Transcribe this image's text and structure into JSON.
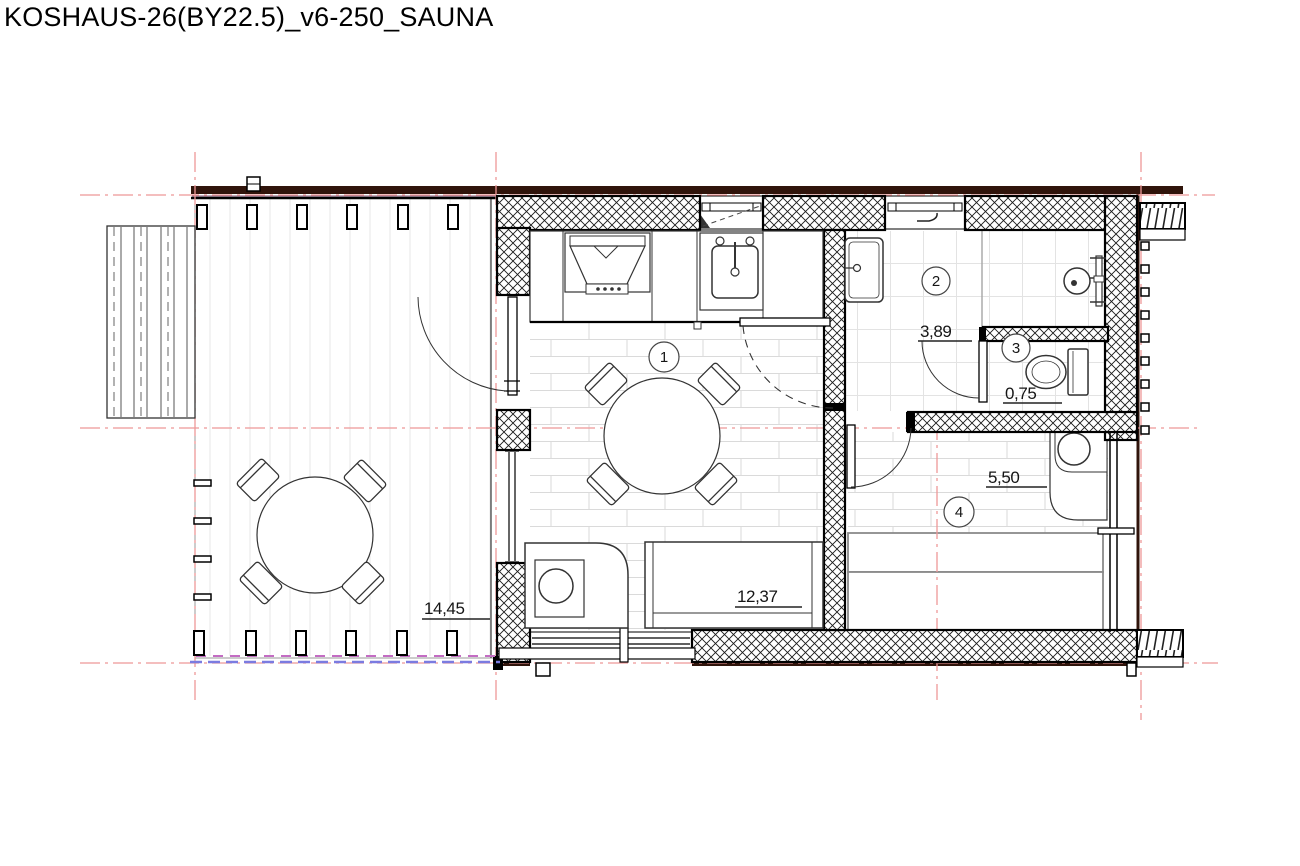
{
  "title": "KOSHAUS-26(BY22.5)_v6-250_SAUNA",
  "plan": {
    "rooms": [
      {
        "number": "1",
        "area": "12,37"
      },
      {
        "number": "2",
        "area": "3,89"
      },
      {
        "number": "3",
        "area": "0,75"
      },
      {
        "number": "4",
        "area": "5,50"
      }
    ],
    "terrace": {
      "area": "14,45"
    },
    "colors": {
      "axis_red": "#ee9898",
      "beam_dark": "#30140b",
      "dash_blue": "#7b7be0",
      "dash_magenta": "#c36cc3",
      "wall_hatch": "#1a1a1a"
    }
  }
}
